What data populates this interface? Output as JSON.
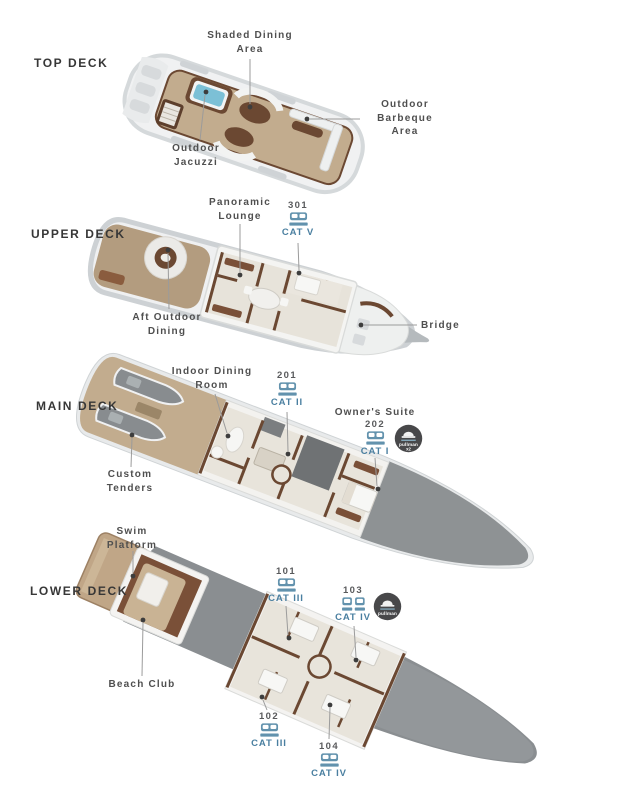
{
  "page": {
    "background": "#ffffff"
  },
  "colors": {
    "category_label": "#4a7fa0",
    "bed_icon": "#6292ad",
    "pullman_badge_background": "#48484a",
    "pullman_badge_accent": "#87aec2",
    "annotation_text": "#4f4f4f",
    "deck_title_text": "#373737",
    "cabin_number_text": "#595a5c",
    "leader_line": "#9b9b9b",
    "hull_gray": "#8e9294",
    "hull_white": "#eff0f1",
    "teak_deck": "#c2ac8e",
    "wood_brown": "#6b4832",
    "interior_floor": "#e8e4db",
    "jacuzzi_water": "#7cc0d6"
  },
  "icons": {
    "double_bed": "double-bed-icon",
    "twin_beds": "twin-beds-icon",
    "pullman": "pullman-bed-icon"
  },
  "decks": [
    {
      "title": "TOP DECK",
      "annotations": {
        "shaded_dining": {
          "line1": "Shaded Dining",
          "line2": "Area"
        },
        "outdoor_jacuzzi": {
          "line1": "Outdoor",
          "line2": "Jacuzzi"
        },
        "outdoor_barbeque": {
          "line1": "Outdoor",
          "line2": "Barbeque",
          "line3": "Area"
        }
      }
    },
    {
      "title": "UPPER DECK",
      "annotations": {
        "panoramic_lounge": {
          "line1": "Panoramic",
          "line2": "Lounge"
        },
        "aft_outdoor_dining": {
          "line1": "Aft Outdoor",
          "line2": "Dining"
        },
        "bridge": {
          "line1": "Bridge"
        }
      },
      "cabins": {
        "cabin_301": {
          "number": "301",
          "category": "CAT V",
          "bed_type": "double"
        }
      }
    },
    {
      "title": "MAIN DECK",
      "annotations": {
        "indoor_dining_room": {
          "line1": "Indoor Dining",
          "line2": "Room"
        },
        "custom_tenders": {
          "line1": "Custom",
          "line2": "Tenders"
        }
      },
      "cabins": {
        "cabin_201": {
          "number": "201",
          "category": "CAT II",
          "bed_type": "double"
        },
        "cabin_202": {
          "label": "Owner's Suite",
          "number": "202",
          "category": "CAT I",
          "bed_type": "double",
          "pullman": "x2"
        }
      }
    },
    {
      "title": "LOWER DECK",
      "annotations": {
        "swim_platform": {
          "line1": "Swim",
          "line2": "Platform"
        },
        "beach_club": {
          "line1": "Beach Club"
        }
      },
      "cabins": {
        "cabin_101": {
          "number": "101",
          "category": "CAT III",
          "bed_type": "double"
        },
        "cabin_103": {
          "number": "103",
          "category": "CAT IV",
          "bed_type": "twin",
          "pullman": ""
        },
        "cabin_102": {
          "number": "102",
          "category": "CAT III",
          "bed_type": "double"
        },
        "cabin_104": {
          "number": "104",
          "category": "CAT IV",
          "bed_type": "double"
        }
      }
    }
  ],
  "badges": {
    "pullman": {
      "label": "pullman"
    },
    "pullman_x2": {
      "label": "pullman",
      "multiplier": "x2"
    }
  }
}
